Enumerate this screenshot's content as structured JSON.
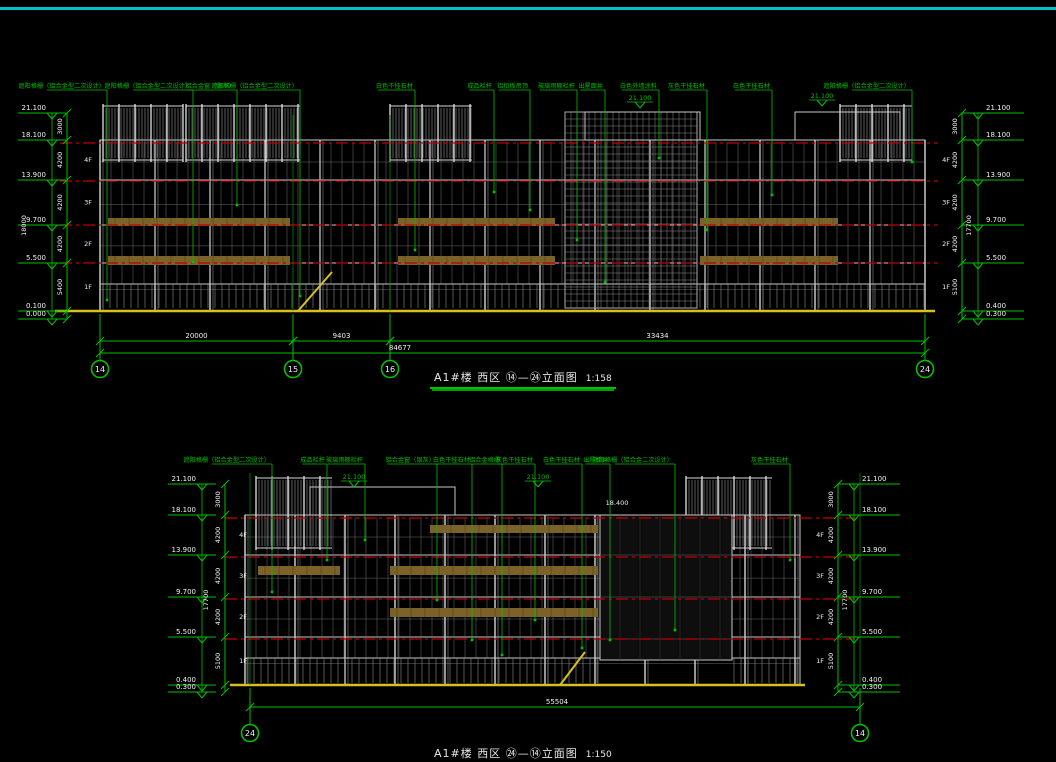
{
  "app": {
    "top_border_color": "#00c4c4",
    "background": "#000000"
  },
  "colors": {
    "annotation_green": "#00c000",
    "linework_white": "#c8c8c8",
    "axis_red": "#c00000",
    "ground_yellow": "#d8c020",
    "spandrel_olive": "#7a6228",
    "text_white": "#f0f0f0"
  },
  "drawings": [
    {
      "name": "west-elevation-upper",
      "title": "A1#楼 西区 ⑭—㉔立面图",
      "scale": "1:158",
      "left": {
        "elevations": [
          "21.100",
          "18.100",
          "13.900",
          "9.700",
          "5.500",
          "0.100",
          "0.000"
        ],
        "segments": [
          "3000",
          "4200",
          "4200",
          "4200",
          "5400"
        ],
        "overall": "18000",
        "floors": [
          "4F",
          "3F",
          "2F",
          "1F"
        ]
      },
      "right": {
        "elevations": [
          "21.100",
          "18.100",
          "13.900",
          "9.700",
          "5.500",
          "0.400",
          "0.300"
        ],
        "segments": [
          "3000",
          "4200",
          "4200",
          "4200",
          "5100"
        ],
        "overall": "17700",
        "floors": [
          "4F",
          "3F",
          "2F",
          "1F"
        ]
      },
      "annotations": [
        {
          "x": 107,
          "drop": 300,
          "label": "遮阳格栅（铝合金型二次设计）"
        },
        {
          "x": 193,
          "drop": 262,
          "label": "遮阳格栅（铝合金型二次设计）"
        },
        {
          "x": 237,
          "drop": 205,
          "label": "铝合金窗（银灰）"
        },
        {
          "x": 300,
          "drop": 296,
          "label": "遮阳格栅（铝合金型二次设计）"
        },
        {
          "x": 415,
          "drop": 250,
          "label": "白色干挂石材"
        },
        {
          "x": 494,
          "drop": 192,
          "label": "成品栏杆"
        },
        {
          "x": 530,
          "drop": 210,
          "label": "铝扣板吊顶"
        },
        {
          "x": 577,
          "drop": 240,
          "label": "玻璃雨棚栏杆"
        },
        {
          "x": 605,
          "drop": 282,
          "label": "出屋面井"
        },
        {
          "x": 659,
          "drop": 158,
          "label": "白色外墙涂料"
        },
        {
          "x": 707,
          "drop": 230,
          "label": "灰色干挂石材"
        },
        {
          "x": 772,
          "drop": 195,
          "label": "白色干挂石材"
        },
        {
          "x": 912,
          "drop": 162,
          "label": "遮阳格栅（铝合金型二次设计）"
        }
      ],
      "inner_marks": [
        {
          "x": 640,
          "y": 100,
          "text": "21.100"
        },
        {
          "x": 822,
          "y": 98,
          "text": "21.100"
        }
      ],
      "grid_bubbles": [
        {
          "x": 100,
          "label": "14"
        },
        {
          "x": 293,
          "label": "15"
        },
        {
          "x": 390,
          "label": "16"
        },
        {
          "x": 925,
          "label": "24"
        }
      ],
      "dims_upper": [
        {
          "from": 100,
          "to": 293,
          "text": "20000"
        },
        {
          "from": 293,
          "to": 390,
          "text": "9403"
        },
        {
          "from": 390,
          "to": 925,
          "text": "33434"
        }
      ],
      "dims_total": {
        "from": 100,
        "to": 925,
        "text": "84677",
        "tx": 400
      }
    },
    {
      "name": "west-elevation-lower",
      "title": "A1#楼 西区 ㉔—⑭立面图",
      "scale": "1:150",
      "left": {
        "elevations": [
          "21.100",
          "18.100",
          "13.900",
          "9.700",
          "5.500",
          "0.400",
          "0.300"
        ],
        "segments": [
          "3000",
          "4200",
          "4200",
          "4200",
          "5100"
        ],
        "overall": "17700",
        "floors": [
          "4F",
          "3F",
          "2F",
          "1F"
        ]
      },
      "right": {
        "elevations": [
          "21.100",
          "18.100",
          "13.900",
          "9.700",
          "5.500",
          "0.400",
          "0.300"
        ],
        "segments": [
          "3000",
          "4200",
          "4200",
          "4200",
          "5100"
        ],
        "overall": "17700",
        "floors": [
          "4F",
          "3F",
          "2F",
          "1F"
        ]
      },
      "annotations": [
        {
          "x": 272,
          "drop": 592,
          "label": "遮阳格栅（铝合金型二次设计）"
        },
        {
          "x": 327,
          "drop": 560,
          "label": "成品栏杆"
        },
        {
          "x": 365,
          "drop": 540,
          "label": "玻璃雨棚栏杆"
        },
        {
          "x": 437,
          "drop": 600,
          "label": "铝合金窗（银灰）"
        },
        {
          "x": 472,
          "drop": 640,
          "label": "白色干挂石材"
        },
        {
          "x": 502,
          "drop": 655,
          "label": "铝合金格栅"
        },
        {
          "x": 535,
          "drop": 620,
          "label": "灰色干挂石材"
        },
        {
          "x": 582,
          "drop": 648,
          "label": "白色干挂石材"
        },
        {
          "x": 610,
          "drop": 640,
          "label": "出屋面井"
        },
        {
          "x": 675,
          "drop": 630,
          "label": "遮阳格栅（铝合金二次设计）"
        },
        {
          "x": 790,
          "drop": 560,
          "label": "灰色干挂石材"
        }
      ],
      "inner_marks": [
        {
          "x": 354,
          "y": 479,
          "text": "21.100"
        },
        {
          "x": 538,
          "y": 479,
          "text": "21.100"
        },
        {
          "x": 617,
          "y": 505,
          "text": "18.400",
          "white": true
        }
      ],
      "grid_bubbles": [
        {
          "x": 250,
          "label": "24"
        },
        {
          "x": 860,
          "label": "14"
        }
      ],
      "dims_upper": [],
      "dims_total": {
        "from": 250,
        "to": 860,
        "text": "55504",
        "tx": 557
      }
    }
  ]
}
